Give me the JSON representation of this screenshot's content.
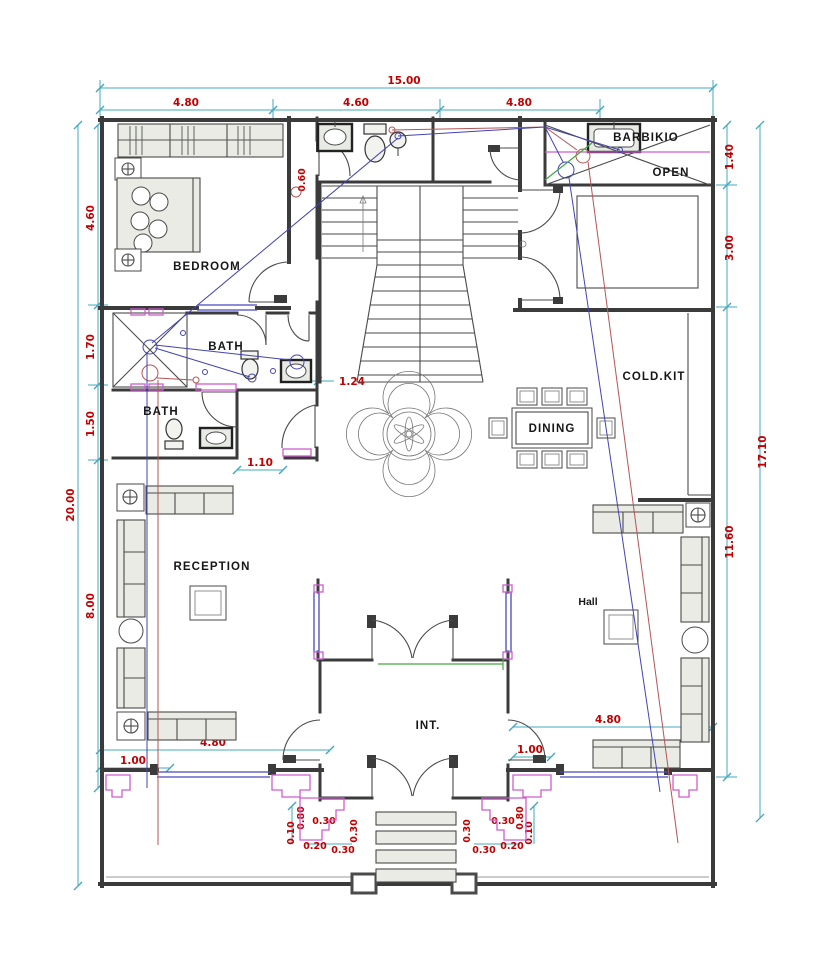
{
  "drawing": {
    "rooms": {
      "bedroom": "BEDROOM",
      "bath_upper": "BATH",
      "bath_lower": "BATH",
      "reception": "RECEPTION",
      "dining": "DINING",
      "cold_kitchen": "COLD.KIT",
      "barbecue": "BARBIKIO",
      "open_area": "OPEN",
      "hall": "Hall",
      "entrance": "INT."
    },
    "dimensions": {
      "overall_width": "15.00",
      "top_segments": [
        "4.80",
        "4.60",
        "4.80"
      ],
      "overall_height_left": "20.00",
      "left_segments": [
        "4.60",
        "1.70",
        "1.50",
        "8.00"
      ],
      "overall_height_right": "17.10",
      "right_segments": [
        "1.40",
        "3.00",
        "11.60"
      ],
      "bottom_left_inset": "1.00",
      "bottom_left_width": "4.80",
      "bottom_right_inset": "1.00",
      "bottom_right_width": "4.80",
      "stair_clearance": "1.24",
      "bath_passage": "1.10",
      "door_offset": "0.60",
      "entrance_left": [
        "0.10",
        "0.80",
        "0.30",
        "0.30",
        "0.20",
        "0.30"
      ],
      "entrance_right": [
        "0.30",
        "0.30",
        "0.20",
        "0.30",
        "0.80",
        "0.10"
      ]
    },
    "colors": {
      "walls": "#3b3b3b",
      "dimension_lines": "#3fa8c0",
      "dimension_text": "#c00000",
      "furniture_fill": "#e9ebe4",
      "wiring_blue": "#4343b5",
      "wiring_red": "#b35555",
      "wiring_green": "#43a843",
      "trim_magenta": "#cf5ccf",
      "window_blue": "#4848c0"
    }
  }
}
